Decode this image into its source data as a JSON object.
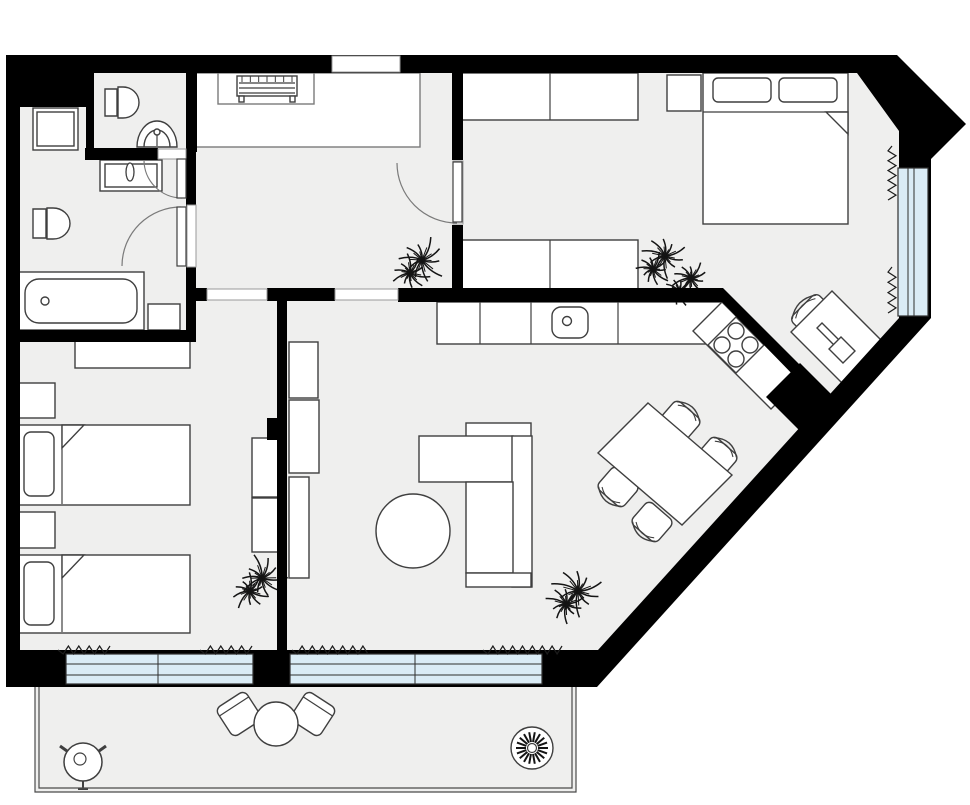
{
  "canvas": {
    "w": 970,
    "h": 805
  },
  "palette": {
    "background": "#ffffff",
    "wall": "#000000",
    "floor": "#efefee",
    "furniture_fill": "#ffffff",
    "furniture_stroke": "#3f3f3f",
    "light_stroke": "#7a7a7a",
    "threshold_stroke": "#9a9a9a",
    "window_glass": "#daecf6",
    "window_frame": "#2f2f2f",
    "curtain": "#1c1c1c",
    "plant": "#141414",
    "rail": "#4a4a4a"
  },
  "floor": {
    "outer_outline": [
      [
        6,
        55
      ],
      [
        897,
        55
      ],
      [
        966,
        124
      ],
      [
        931,
        159
      ],
      [
        931,
        318
      ],
      [
        597,
        687
      ],
      [
        6,
        687
      ]
    ],
    "inner_outline": [
      [
        20,
        73
      ],
      [
        857,
        73
      ],
      [
        899,
        131
      ],
      [
        899,
        318
      ],
      [
        598,
        650
      ],
      [
        20,
        650
      ]
    ]
  },
  "walls": {
    "rects": [
      {
        "name": "corner-block-wall",
        "x": 6,
        "y": 55,
        "w": 88,
        "h": 52
      },
      {
        "name": "wc-east-wall",
        "x": 186,
        "y": 55,
        "w": 11,
        "h": 97
      },
      {
        "name": "wc-south-wall",
        "x": 85,
        "y": 148,
        "w": 73,
        "h": 12
      },
      {
        "name": "wc-west-stub-wall",
        "x": 86,
        "y": 105,
        "w": 8,
        "h": 48
      },
      {
        "name": "bathroom-east-wall-upper",
        "x": 186,
        "y": 152,
        "w": 10,
        "h": 55
      },
      {
        "name": "bathroom-east-wall-lower",
        "x": 186,
        "y": 266,
        "w": 10,
        "h": 76
      },
      {
        "name": "bathroom-south-wall",
        "x": 6,
        "y": 330,
        "w": 190,
        "h": 12
      },
      {
        "name": "hall-south-wall-west",
        "x": 196,
        "y": 288,
        "w": 11,
        "h": 13
      },
      {
        "name": "hall-south-wall-mid",
        "x": 267,
        "y": 288,
        "w": 68,
        "h": 13
      },
      {
        "name": "kitchen-north-wall",
        "x": 398,
        "y": 288,
        "w": 325,
        "h": 14
      },
      {
        "name": "bedroom2-west-wall-upper",
        "x": 452,
        "y": 55,
        "w": 11,
        "h": 105
      },
      {
        "name": "bedroom2-west-wall-lower",
        "x": 452,
        "y": 225,
        "w": 11,
        "h": 64
      },
      {
        "name": "living-west-wall",
        "x": 277,
        "y": 299,
        "w": 10,
        "h": 355
      },
      {
        "name": "living-west-wall-jog",
        "x": 267,
        "y": 418,
        "w": 12,
        "h": 22
      }
    ],
    "polys": [
      {
        "name": "kitchen-diagonal-wall",
        "pts": [
          [
            723,
            288
          ],
          [
            800,
            365
          ],
          [
            800,
            382
          ],
          [
            722,
            302
          ]
        ]
      },
      {
        "name": "diagonal-wall-jog",
        "pts": [
          [
            800,
            363
          ],
          [
            833,
            396
          ],
          [
            799,
            430
          ],
          [
            766,
            397
          ]
        ]
      }
    ]
  },
  "openings": [
    {
      "name": "entrance-door-opening",
      "x": 332,
      "y": 56,
      "w": 68,
      "h": 16
    },
    {
      "name": "bedroom1-door-opening",
      "x": 207,
      "y": 289,
      "w": 60,
      "h": 11
    },
    {
      "name": "living-passage-opening",
      "x": 335,
      "y": 289,
      "w": 63,
      "h": 11
    },
    {
      "name": "wc-door-opening",
      "x": 158,
      "y": 149,
      "w": 28,
      "h": 10
    },
    {
      "name": "bathroom-door-opening",
      "x": 187,
      "y": 205,
      "w": 9,
      "h": 62
    },
    {
      "name": "bedroom2-door-opening",
      "x": 453,
      "y": 161,
      "w": 10,
      "h": 63
    }
  ],
  "doors": [
    {
      "name": "wc-door",
      "leaf": {
        "x": 177,
        "y": 159,
        "w": 9,
        "h": 39
      },
      "arc": "M182,198 A38,38 0 0 1 144,160"
    },
    {
      "name": "bathroom-door",
      "leaf": {
        "x": 177,
        "y": 207,
        "w": 9,
        "h": 59
      },
      "arc": "M181,207 A59,59 0 0 0 122,266"
    },
    {
      "name": "bedroom2-door",
      "leaf": {
        "x": 453,
        "y": 162,
        "w": 9,
        "h": 60
      },
      "arc": "M457,223 A60,60 0 0 1 397,163"
    }
  ],
  "windows": [
    {
      "name": "bedroom1-window",
      "x": 66,
      "y": 654,
      "w": 187,
      "h": 30,
      "lines": [
        [
          66,
          664,
          253,
          664
        ],
        [
          66,
          675,
          253,
          675
        ],
        [
          158,
          654,
          158,
          684
        ]
      ]
    },
    {
      "name": "living-window",
      "x": 290,
      "y": 654,
      "w": 252,
      "h": 30,
      "lines": [
        [
          290,
          664,
          542,
          664
        ],
        [
          290,
          675,
          542,
          675
        ],
        [
          415,
          654,
          415,
          684
        ]
      ]
    },
    {
      "name": "bedroom2-window",
      "x": 898,
      "y": 168,
      "w": 30,
      "h": 148,
      "lines": [
        [
          908,
          168,
          908,
          316
        ],
        [
          914,
          168,
          914,
          316
        ]
      ]
    }
  ],
  "curtains": [
    {
      "name": "curtain-bedroom1-left",
      "x1": 58,
      "y1": 650,
      "x2": 110,
      "y2": 650
    },
    {
      "name": "curtain-bedroom1-right",
      "x1": 200,
      "y1": 650,
      "x2": 252,
      "y2": 650
    },
    {
      "name": "curtain-living-left",
      "x1": 292,
      "y1": 650,
      "x2": 368,
      "y2": 650
    },
    {
      "name": "curtain-living-right",
      "x1": 483,
      "y1": 650,
      "x2": 562,
      "y2": 650
    },
    {
      "name": "curtain-bedroom2-upper",
      "x1": 892,
      "y1": 146,
      "x2": 892,
      "y2": 200
    },
    {
      "name": "curtain-bedroom2-lower",
      "x1": 892,
      "y1": 267,
      "x2": 892,
      "y2": 313
    }
  ],
  "balcony": {
    "floor": {
      "x": 35,
      "y": 687,
      "w": 541,
      "h": 105
    },
    "rails": [
      "M35,687 V792 H576 V687",
      "M39,687 V788 H572 V687"
    ]
  },
  "furniture": [
    {
      "type": "rect",
      "name": "washing-machine",
      "x": 33,
      "y": 108,
      "w": 45,
      "h": 42
    },
    {
      "type": "rect",
      "name": "washing-machine-inner",
      "x": 37,
      "y": 112,
      "w": 37,
      "h": 34
    },
    {
      "type": "path",
      "name": "toilet-wc",
      "d": "M105,89 h12 v27 h-12 z M118,87 h5 a16,15.5 0 0 1 0,31 h-5 z"
    },
    {
      "type": "path",
      "name": "corner-sink-wc",
      "d": "M137,147 a20,26 0 0 1 40,0 z M144,147 a13,17 0 0 1 26,0"
    },
    {
      "type": "circle",
      "name": "corner-sink-faucet",
      "cx": 157,
      "cy": 132,
      "r": 3
    },
    {
      "type": "line",
      "name": "corner-sink-tap",
      "x1": 157,
      "y1": 135,
      "x2": 157,
      "y2": 146
    },
    {
      "type": "rect",
      "name": "vanity-sink",
      "x": 100,
      "y": 160,
      "w": 62,
      "h": 31
    },
    {
      "type": "rect",
      "name": "vanity-sink-inner",
      "x": 105,
      "y": 164,
      "w": 52,
      "h": 23
    },
    {
      "type": "ellipse",
      "name": "vanity-knob",
      "cx": 130,
      "cy": 172,
      "rx": 4,
      "ry": 9
    },
    {
      "type": "path",
      "name": "toilet-bathroom",
      "d": "M33,209 h13 v29 h-13 z M47,208 h6 a17,15.5 0 0 1 0,31 h-6 z"
    },
    {
      "type": "rect",
      "name": "bathtub",
      "x": 18,
      "y": 272,
      "w": 126,
      "h": 58
    },
    {
      "type": "rect",
      "name": "bathtub-inner",
      "x": 25,
      "y": 279,
      "w": 112,
      "h": 44,
      "rx": 14
    },
    {
      "type": "circle",
      "name": "bathtub-drain",
      "cx": 45,
      "cy": 301,
      "r": 4
    },
    {
      "type": "rect",
      "name": "bathroom-cabinet",
      "x": 148,
      "y": 304,
      "w": 32,
      "h": 26
    },
    {
      "type": "rect",
      "name": "entry-closet",
      "x": 196,
      "y": 73,
      "w": 224,
      "h": 74,
      "stroke": "light"
    },
    {
      "type": "rect",
      "name": "entry-closet-alcove",
      "x": 218,
      "y": 73,
      "w": 96,
      "h": 31,
      "stroke": "light"
    },
    {
      "type": "rect",
      "name": "entry-bench",
      "x": 237,
      "y": 76,
      "w": 60,
      "h": 20
    },
    {
      "type": "ticks",
      "name": "entry-bench-slats-ticks",
      "x1": 242,
      "x2": 292,
      "y1": 76,
      "y2": 82,
      "n": 7
    },
    {
      "type": "line",
      "name": "entry-bench-slat-1",
      "x1": 239,
      "y1": 83,
      "x2": 295,
      "y2": 83
    },
    {
      "type": "line",
      "name": "entry-bench-slat-2",
      "x1": 239,
      "y1": 88,
      "x2": 295,
      "y2": 88
    },
    {
      "type": "line",
      "name": "entry-bench-slat-3",
      "x1": 239,
      "y1": 93,
      "x2": 295,
      "y2": 93
    },
    {
      "type": "rect",
      "name": "entry-bench-leg-left",
      "x": 239,
      "y": 96,
      "w": 5,
      "h": 6
    },
    {
      "type": "rect",
      "name": "entry-bench-leg-right",
      "x": 290,
      "y": 96,
      "w": 5,
      "h": 6
    },
    {
      "type": "rect",
      "name": "bedroom1-desk",
      "x": 75,
      "y": 340,
      "w": 115,
      "h": 28
    },
    {
      "type": "rect",
      "name": "bedroom1-nightstand-1",
      "x": 18,
      "y": 383,
      "w": 37,
      "h": 35
    },
    {
      "type": "rect",
      "name": "bedroom1-bed-1",
      "x": 18,
      "y": 425,
      "w": 172,
      "h": 80
    },
    {
      "type": "rect",
      "name": "bedroom1-bed-1-pillow",
      "x": 24,
      "y": 432,
      "w": 30,
      "h": 64,
      "rx": 7
    },
    {
      "type": "line",
      "name": "bedroom1-bed-1-blanket",
      "x1": 62,
      "y1": 426,
      "x2": 62,
      "y2": 504
    },
    {
      "type": "poly",
      "name": "bedroom1-bed-1-fold",
      "pts": [
        [
          62,
          425
        ],
        [
          84,
          425
        ],
        [
          62,
          448
        ]
      ]
    },
    {
      "type": "rect",
      "name": "bedroom1-nightstand-2",
      "x": 18,
      "y": 512,
      "w": 37,
      "h": 36
    },
    {
      "type": "rect",
      "name": "bedroom1-bed-2",
      "x": 18,
      "y": 555,
      "w": 172,
      "h": 78
    },
    {
      "type": "rect",
      "name": "bedroom1-bed-2-pillow",
      "x": 24,
      "y": 562,
      "w": 30,
      "h": 63,
      "rx": 7
    },
    {
      "type": "line",
      "name": "bedroom1-bed-2-blanket",
      "x1": 62,
      "y1": 556,
      "x2": 62,
      "y2": 632
    },
    {
      "type": "poly",
      "name": "bedroom1-bed-2-fold",
      "pts": [
        [
          62,
          555
        ],
        [
          84,
          555
        ],
        [
          62,
          578
        ]
      ]
    },
    {
      "type": "rect",
      "name": "bedroom1-wardrobe-1",
      "x": 252,
      "y": 438,
      "w": 28,
      "h": 59
    },
    {
      "type": "rect",
      "name": "bedroom1-wardrobe-2",
      "x": 252,
      "y": 498,
      "w": 28,
      "h": 54
    },
    {
      "type": "rect",
      "name": "living-shelf-1",
      "x": 289,
      "y": 342,
      "w": 29,
      "h": 56
    },
    {
      "type": "rect",
      "name": "living-shelf-2",
      "x": 289,
      "y": 400,
      "w": 30,
      "h": 73
    },
    {
      "type": "rect",
      "name": "living-shelf-3",
      "x": 289,
      "y": 477,
      "w": 20,
      "h": 101
    },
    {
      "type": "rect",
      "name": "sofa-back-top",
      "x": 466,
      "y": 423,
      "w": 65,
      "h": 14
    },
    {
      "type": "rect",
      "name": "sofa-chaise",
      "x": 419,
      "y": 436,
      "w": 94,
      "h": 46
    },
    {
      "type": "rect",
      "name": "sofa-back-right",
      "x": 512,
      "y": 436,
      "w": 20,
      "h": 151
    },
    {
      "type": "rect",
      "name": "sofa-seat",
      "x": 466,
      "y": 482,
      "w": 47,
      "h": 91
    },
    {
      "type": "rect",
      "name": "sofa-armrest",
      "x": 466,
      "y": 573,
      "w": 65,
      "h": 14
    },
    {
      "type": "circle",
      "name": "coffee-table",
      "cx": 413,
      "cy": 531,
      "r": 37
    },
    {
      "type": "rect",
      "name": "kitchen-counter",
      "x": 437,
      "y": 302,
      "w": 286,
      "h": 42
    },
    {
      "type": "line",
      "name": "kitchen-counter-div-1",
      "x1": 480,
      "y1": 302,
      "x2": 480,
      "y2": 344
    },
    {
      "type": "line",
      "name": "kitchen-counter-div-2",
      "x1": 531,
      "y1": 302,
      "x2": 531,
      "y2": 344
    },
    {
      "type": "line",
      "name": "kitchen-counter-div-3",
      "x1": 618,
      "y1": 302,
      "x2": 618,
      "y2": 344
    },
    {
      "type": "rect",
      "name": "kitchen-sink",
      "x": 552,
      "y": 307,
      "w": 36,
      "h": 31,
      "rx": 9
    },
    {
      "type": "circle",
      "name": "kitchen-sink-faucet",
      "cx": 567,
      "cy": 321,
      "r": 4.5
    },
    {
      "type": "poly",
      "name": "kitchen-counter-diagonal",
      "pts": [
        [
          722,
          302
        ],
        [
          800,
          380
        ],
        [
          771,
          409
        ],
        [
          693,
          331
        ]
      ]
    },
    {
      "type": "poly",
      "name": "stove",
      "pts": [
        [
          736,
          317
        ],
        [
          764,
          345
        ],
        [
          736,
          373
        ],
        [
          708,
          345
        ]
      ]
    },
    {
      "type": "circle",
      "name": "stove-burner-1",
      "cx": 736,
      "cy": 331,
      "r": 8
    },
    {
      "type": "circle",
      "name": "stove-burner-2",
      "cx": 750,
      "cy": 345,
      "r": 8
    },
    {
      "type": "circle",
      "name": "stove-burner-3",
      "cx": 736,
      "cy": 359,
      "r": 8
    },
    {
      "type": "circle",
      "name": "stove-burner-4",
      "cx": 722,
      "cy": 345,
      "r": 8
    },
    {
      "type": "chair",
      "name": "dining-chair-1",
      "cx": 680,
      "cy": 421,
      "rot": 41,
      "w": 34,
      "h": 29,
      "back": "arc"
    },
    {
      "type": "chair",
      "name": "dining-chair-2",
      "cx": 717,
      "cy": 457,
      "rot": 41,
      "w": 34,
      "h": 29,
      "back": "arc"
    },
    {
      "type": "chair",
      "name": "dining-chair-3",
      "cx": 618,
      "cy": 487,
      "rot": 221,
      "w": 34,
      "h": 29,
      "back": "arc"
    },
    {
      "type": "chair",
      "name": "dining-chair-4",
      "cx": 652,
      "cy": 522,
      "rot": 221,
      "w": 34,
      "h": 29,
      "back": "arc"
    },
    {
      "type": "poly",
      "name": "dining-table",
      "pts": [
        [
          648,
          403
        ],
        [
          732,
          475
        ],
        [
          682,
          525
        ],
        [
          598,
          453
        ]
      ]
    },
    {
      "type": "rect",
      "name": "bedroom2-wardrobe-top",
      "x": 462,
      "y": 73,
      "w": 176,
      "h": 47
    },
    {
      "type": "line",
      "name": "bedroom2-wardrobe-top-div",
      "x1": 550,
      "y1": 73,
      "x2": 550,
      "y2": 120
    },
    {
      "type": "rect",
      "name": "bedroom2-nightstand",
      "x": 667,
      "y": 75,
      "w": 34,
      "h": 36
    },
    {
      "type": "rect",
      "name": "bedroom2-bed",
      "x": 703,
      "y": 73,
      "w": 145,
      "h": 151
    },
    {
      "type": "rect",
      "name": "bedroom2-pillow-left",
      "x": 713,
      "y": 78,
      "w": 58,
      "h": 24,
      "rx": 5
    },
    {
      "type": "rect",
      "name": "bedroom2-pillow-right",
      "x": 779,
      "y": 78,
      "w": 58,
      "h": 24,
      "rx": 5
    },
    {
      "type": "line",
      "name": "bedroom2-blanket",
      "x1": 703,
      "y1": 112,
      "x2": 848,
      "y2": 112
    },
    {
      "type": "poly",
      "name": "bedroom2-bed-fold",
      "pts": [
        [
          826,
          112
        ],
        [
          848,
          112
        ],
        [
          848,
          134
        ]
      ]
    },
    {
      "type": "rect",
      "name": "bedroom2-wardrobe-bottom",
      "x": 462,
      "y": 240,
      "w": 176,
      "h": 50
    },
    {
      "type": "line",
      "name": "bedroom2-wardrobe-bottom-div",
      "x1": 550,
      "y1": 240,
      "x2": 550,
      "y2": 290
    },
    {
      "type": "chair",
      "name": "bedroom2-desk-chair",
      "cx": 814,
      "cy": 317,
      "rot": -45,
      "w": 38,
      "h": 32,
      "back": "arc"
    },
    {
      "type": "poly",
      "name": "bedroom2-desk",
      "pts": [
        [
          850,
          391
        ],
        [
          891,
          350
        ],
        [
          832,
          291
        ],
        [
          791,
          332
        ]
      ]
    },
    {
      "type": "poly",
      "name": "bedroom2-laptop-bar",
      "pts": [
        [
          838,
          349
        ],
        [
          843,
          344
        ],
        [
          822,
          323
        ],
        [
          817,
          328
        ]
      ]
    },
    {
      "type": "poly",
      "name": "bedroom2-laptop-base",
      "pts": [
        [
          843,
          363
        ],
        [
          855,
          351
        ],
        [
          841,
          337
        ],
        [
          829,
          349
        ]
      ]
    },
    {
      "type": "chair",
      "name": "balcony-chair-left",
      "cx": 239,
      "cy": 714,
      "rot": -33,
      "w": 35,
      "h": 34,
      "back": "band"
    },
    {
      "type": "chair",
      "name": "balcony-chair-right",
      "cx": 313,
      "cy": 714,
      "rot": 33,
      "w": 35,
      "h": 34,
      "back": "band"
    },
    {
      "type": "circle",
      "name": "balcony-table",
      "cx": 276,
      "cy": 724,
      "r": 22
    },
    {
      "type": "grill",
      "name": "balcony-grill",
      "cx": 83,
      "cy": 762,
      "r": 19
    },
    {
      "type": "pot",
      "name": "balcony-potted-plant",
      "cx": 532,
      "cy": 748,
      "r": 21
    },
    {
      "type": "plant",
      "name": "hallway-plant",
      "cx": 417,
      "cy": 266,
      "r": 27
    },
    {
      "type": "plant",
      "name": "bedroom1-plant",
      "cx": 257,
      "cy": 584,
      "r": 27
    },
    {
      "type": "plant",
      "name": "living-plant",
      "cx": 573,
      "cy": 597,
      "r": 29
    },
    {
      "type": "plant",
      "name": "bedroom2-plant-a",
      "cx": 660,
      "cy": 262,
      "r": 25
    },
    {
      "type": "plant",
      "name": "bedroom2-plant-b",
      "cx": 686,
      "cy": 284,
      "r": 21
    }
  ]
}
